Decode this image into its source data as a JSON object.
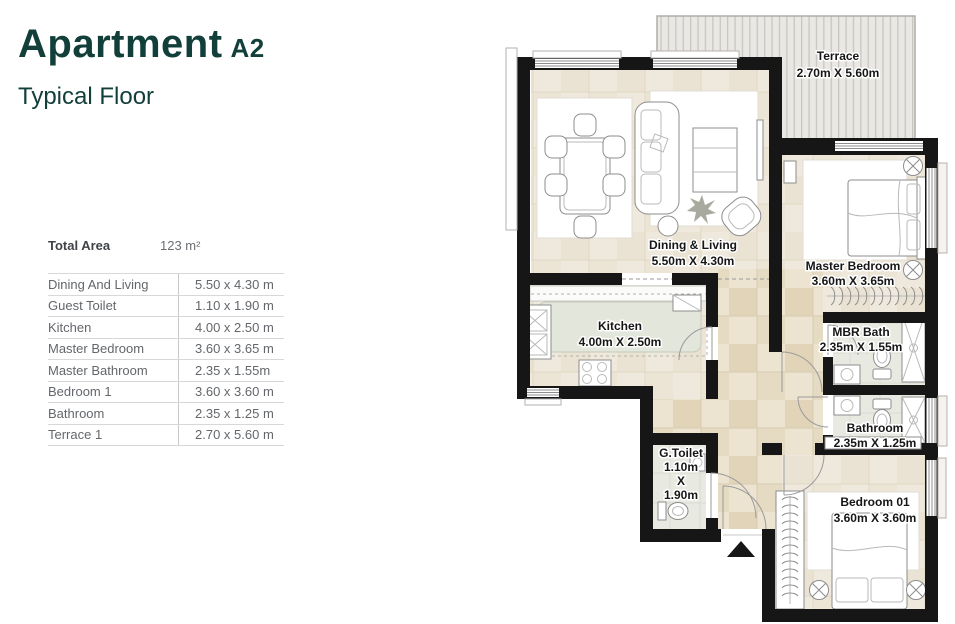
{
  "header": {
    "title": "Apartment",
    "variant": "A2",
    "subtitle": "Typical Floor"
  },
  "summary": {
    "total_area_label": "Total Area",
    "total_area_value": "123 m²"
  },
  "table": {
    "rows": [
      {
        "label": "Dining And Living",
        "value": "5.50 x 4.30 m"
      },
      {
        "label": "Guest Toilet",
        "value": "1.10 x 1.90 m"
      },
      {
        "label": "Kitchen",
        "value": "4.00 x 2.50 m"
      },
      {
        "label": "Master Bedroom",
        "value": "3.60 x 3.65 m"
      },
      {
        "label": "Master Bathroom",
        "value": "2.35 x 1.55m"
      },
      {
        "label": "Bedroom 1",
        "value": "3.60 x 3.60 m"
      },
      {
        "label": "Bathroom",
        "value": "2.35 x 1.25 m"
      },
      {
        "label": "Terrace 1",
        "value": "2.70 x 5.60 m"
      }
    ]
  },
  "plan": {
    "rooms": {
      "terrace": {
        "name": "Terrace",
        "dims": "2.70m X 5.60m"
      },
      "dining_living": {
        "name": "Dining & Living",
        "dims": "5.50m X 4.30m"
      },
      "master_bedroom": {
        "name": "Master Bedroom",
        "dims": "3.60m X 3.65m"
      },
      "kitchen": {
        "name": "Kitchen",
        "dims": "4.00m X 2.50m"
      },
      "mbr_bath": {
        "name": "MBR Bath",
        "dims": "2.35m X 1.55m"
      },
      "bathroom": {
        "name": "Bathroom",
        "dims": "2.35m X 1.25m"
      },
      "g_toilet": {
        "name": "G.Toilet",
        "w": "1.10m",
        "x": "X",
        "h": "1.90m"
      },
      "bedroom_01": {
        "name": "Bedroom 01",
        "dims": "3.60m X 3.60m"
      }
    },
    "colors": {
      "accent": "#123f3a",
      "wall": "#161616",
      "tile": "#ece4d4",
      "bath_tile": "#e8eae2"
    }
  }
}
